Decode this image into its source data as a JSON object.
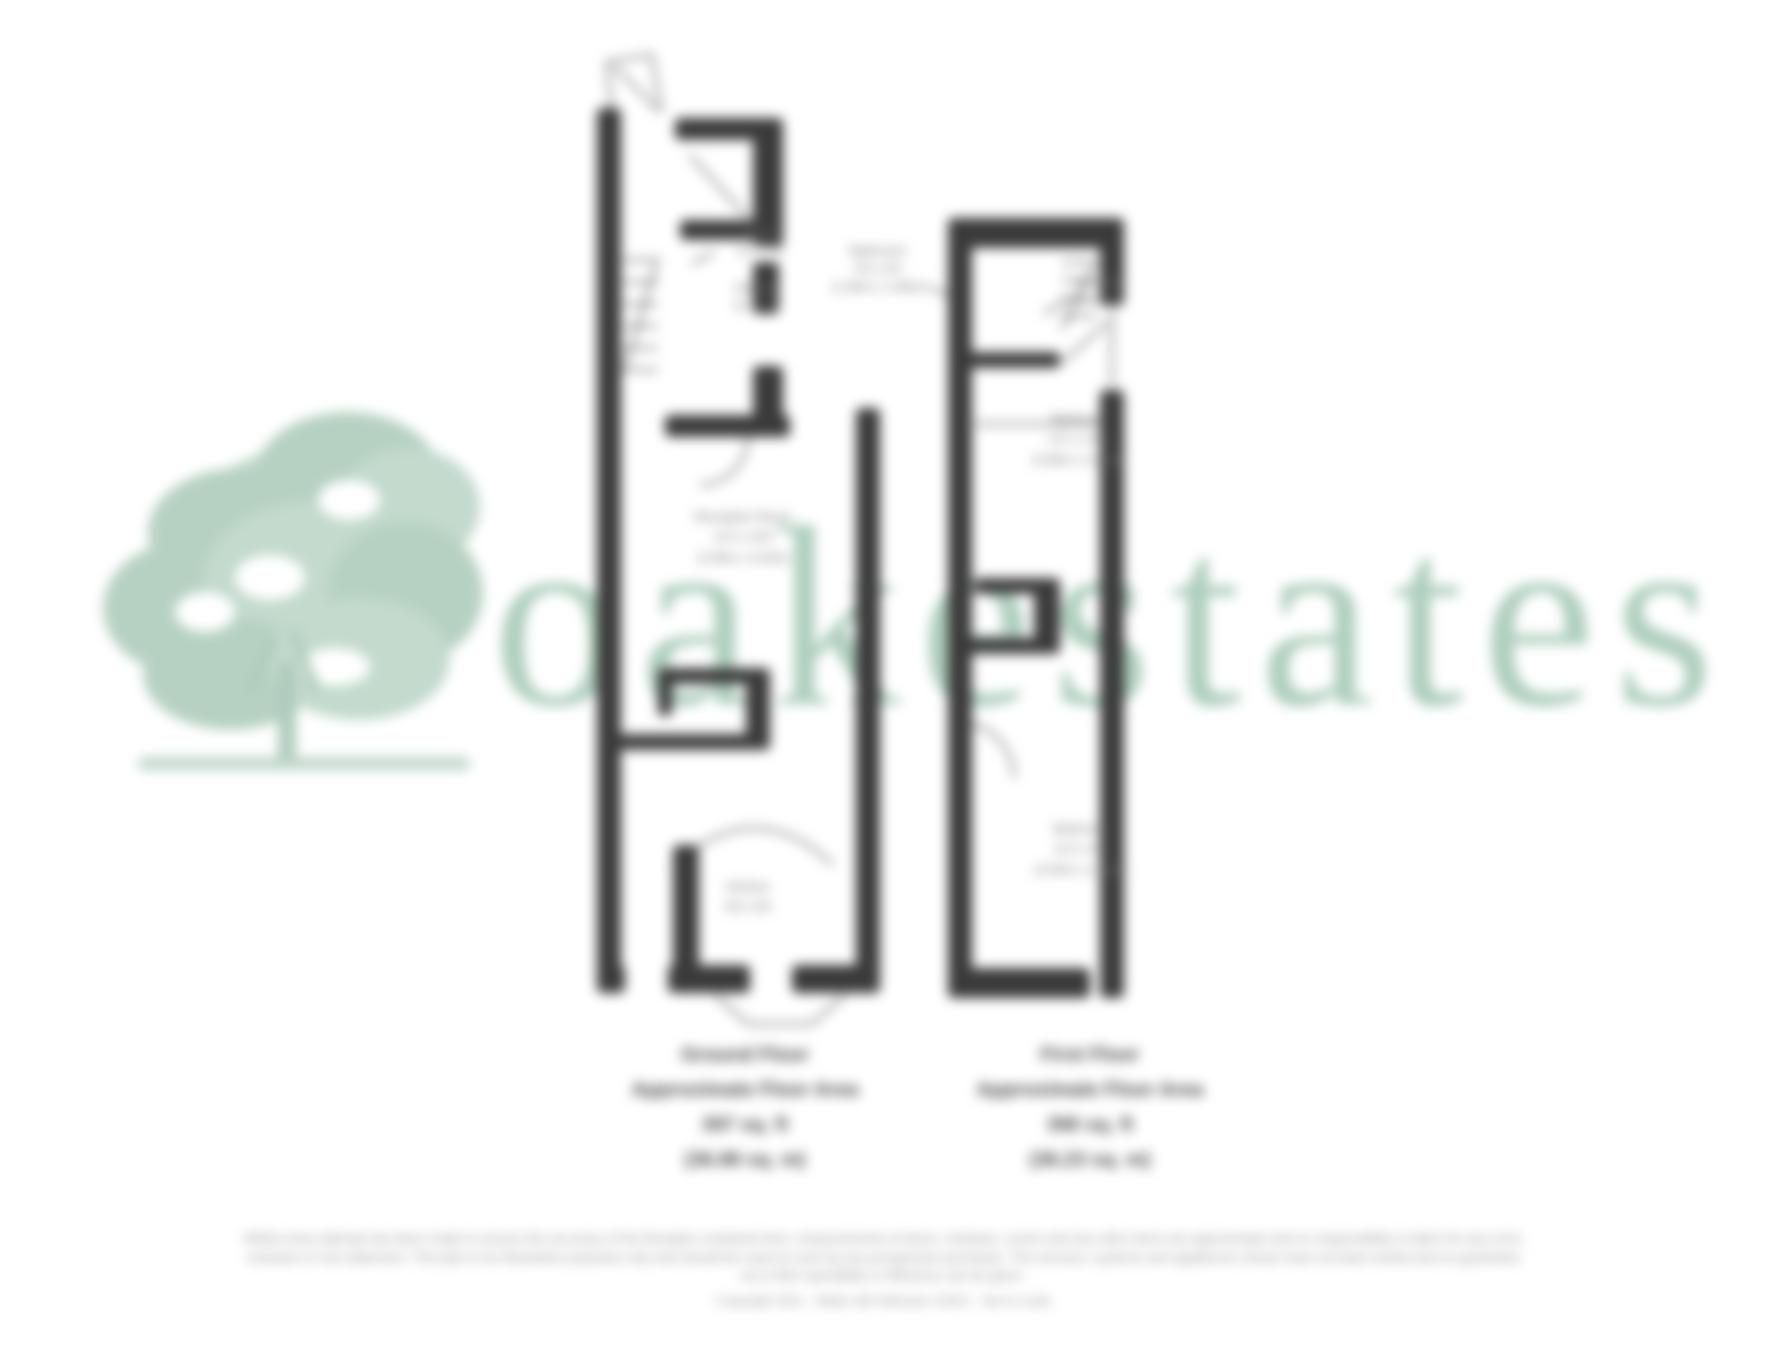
{
  "watermark": {
    "text": "oakestates",
    "color": "#a9cbb9"
  },
  "logo": {
    "name": "oak-tree-logo",
    "color": "#b6d1c2"
  },
  "ground_floor": {
    "caption": {
      "line1": "Ground Floor",
      "line2": "Approximate Floor Area",
      "line3": "397 sq. ft",
      "line4": "(36.88 sq. m)"
    },
    "rooms": {
      "store": {
        "name": "Store",
        "dims": "3'1 x 2'9"
      },
      "hallway": {
        "name": "Hallway",
        "dims": "6'2 x 5'8"
      },
      "reception": {
        "name": "Reception Room",
        "dims": "11'5 x 10'6",
        "metric": "(3.48m x 3.20m)"
      },
      "kitchen": {
        "name": "Kitchen",
        "dims": "9'8 x 8'6",
        "metric": "(2.95m x 2.59m)"
      }
    }
  },
  "first_floor": {
    "caption": {
      "line1": "First Floor",
      "line2": "Approximate Floor Area",
      "line3": "390 sq. ft",
      "line4": "(36.23 sq. m)"
    },
    "rooms": {
      "bathroom": {
        "name": "Bathroom",
        "dims": "6'5 x 5'6",
        "metric": "(1.96m x 1.68m)"
      },
      "landing": {
        "name": "Landing",
        "dims": "8'4 x 2'11"
      },
      "bedroom1": {
        "name": "Bedroom",
        "dims": "12'1 x 10'5",
        "metric": "(3.68m x 3.18m)"
      },
      "bedroom2": {
        "name": "Bedroom",
        "dims": "11'2 x 9'0",
        "metric": "(3.40m x 2.74m)"
      }
    }
  },
  "disclaimer": {
    "line1": "Whilst every attempt has been made to ensure the accuracy of the floorplan contained here, measurements of doors, windows, rooms and any other items are approximate and no responsibility is taken for any error,",
    "line2": "omission or mis-statement. This plan is for illustrative purposes only and should be used as such by any prospective purchaser. The services, systems and appliances shown have not been tested and no guarantee",
    "line3": "as to their operability or efficiency can be given.",
    "line4": "Copyright 2021 · Made with Metropix ©2021 · Not to scale"
  }
}
